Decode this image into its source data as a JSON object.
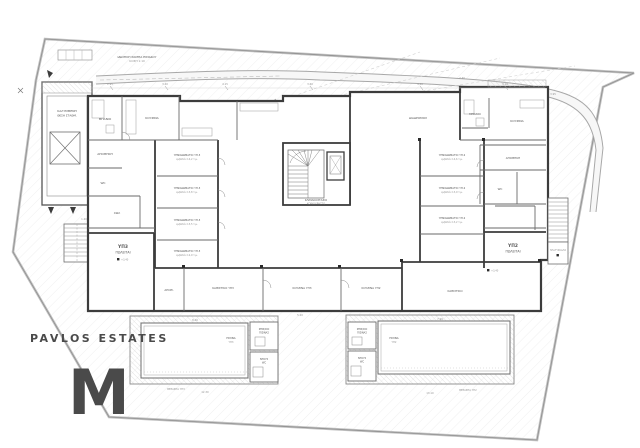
{
  "watermark": {
    "name": "PAVLOS ESTATES",
    "monogram": "M"
  },
  "colors": {
    "wall": "#3c3c3c",
    "line": "#6a6a6a",
    "light": "#9c9c9c",
    "hatch": "#c9c9c9",
    "boundary": "#c2c2c2",
    "dim_text": "#949494",
    "label_text": "#4a4a4a",
    "watermark": "rgba(100,100,115,0.10)"
  },
  "annotations": {
    "ramp_line1": "ΙΔΙΩΤΙΚΗ ΡΑΜΠΑ ΕΙΣΟΔΟΥ",
    "ramp_line2": "ΚΛΙΣΗ 1:10",
    "covered_parking_line1": "ΚΑΛΥΜΜΕΝΗ",
    "covered_parking_line2": "ΘΕΣΗ ΣΤΑΘΜ.",
    "stair_core_line1": "ΚΛΙΜΑΚΟΣΤΑΣΙΟ",
    "stair_core_line2": "ΚΟΙΝΟΧΡΗΣΤΟ",
    "corridor": "ΔΙΑΔΡΟΜΟΣ",
    "right_stair_landing": "ΠΛΑΤΥΣΚΑΛΟ",
    "level_mark": "+3,40"
  },
  "units": {
    "yp3": {
      "id": "ΥΠ3",
      "status": "ΠΩΛΕΙΤΑΙ"
    },
    "yp2": {
      "id": "ΥΠ2",
      "status": "ΠΩΛΕΙΤΑΙ"
    }
  },
  "rooms": {
    "bath3": "ΜΠΑΝΙΟ",
    "kitchen3": "ΚΟΥΖΙΝΑ",
    "store3": "ΑΠΟΘΗΚΗ",
    "wc3": "WC",
    "hall3": "ΧΩΛ",
    "store3b": "ΑΠΟΘ.",
    "bath2": "ΜΠΑΝΙΟ",
    "kitchen2": "ΚΟΥΖΙΝΑ",
    "store2": "ΑΠΟΘΗΚΗ",
    "wc2": "WC",
    "living_mid1": "ΚΑΘΙΣΤΙΚΟ ΥΠ3",
    "living_mid2": "ΚΟΥΖΙΝΑ ΥΠ3",
    "living_mid3": "ΚΟΥΖΙΝΑ ΥΠ2",
    "living_right": "ΚΑΘΙΣΤΙΚΟ"
  },
  "bedrooms_left": [
    {
      "name": "ΥΠΝΟΔΩΜΑΤΙΟ ΥΠ.3",
      "area": "εμβαδόν 14,2 τ.μ."
    },
    {
      "name": "ΥΠΝΟΔΩΜΑΤΙΟ ΥΠ.3",
      "area": "εμβαδόν 13,8 τ.μ."
    },
    {
      "name": "ΥΠΝΟΔΩΜΑΤΙΟ ΥΠ.3",
      "area": "εμβαδόν 13,5 τ.μ."
    },
    {
      "name": "ΥΠΝΟΔΩΜΑΤΙΟ ΥΠ.3",
      "area": "εμβαδόν 12,9 τ.μ."
    }
  ],
  "bedrooms_right": [
    {
      "name": "ΥΠΝΟΔΩΜΑΤΙΟ ΥΠ.2",
      "area": "εμβαδόν 14,6 τ.μ."
    },
    {
      "name": "ΥΠΝΟΔΩΜΑΤΙΟ ΥΠ.2",
      "area": "εμβαδόν 13,9 τ.μ."
    },
    {
      "name": "ΥΠΝΟΔΩΜΑΤΙΟ ΥΠ.2",
      "area": "εμβαδόν 13,2 τ.μ."
    }
  ],
  "pools": {
    "left_line1": "ΠΙΣΙΝΑ",
    "left_line2": "ΥΠ3",
    "right_line1": "ΠΙΣΙΝΑ",
    "right_line2": "ΥΠ2",
    "plant_line1": "ΜΗΧ/ΣΙΟ",
    "plant_line2": "ΠΙΣΙΝΑΣ",
    "shower_line1": "ΝΤΟΥΣ",
    "shower_line2": "WC",
    "veranda_left": "ΒΕΡΑΝΤΑ ΥΠ3",
    "veranda_right": "ΒΕΡΑΝΤΑ ΥΠ2"
  },
  "dims": [
    "2.95",
    "3.40",
    "4.15",
    "3.60",
    "4.30",
    "3.10",
    "5.20",
    "8.40",
    "7.90",
    "12.30",
    "13.10",
    "1.20",
    "3.95",
    "2.40"
  ]
}
